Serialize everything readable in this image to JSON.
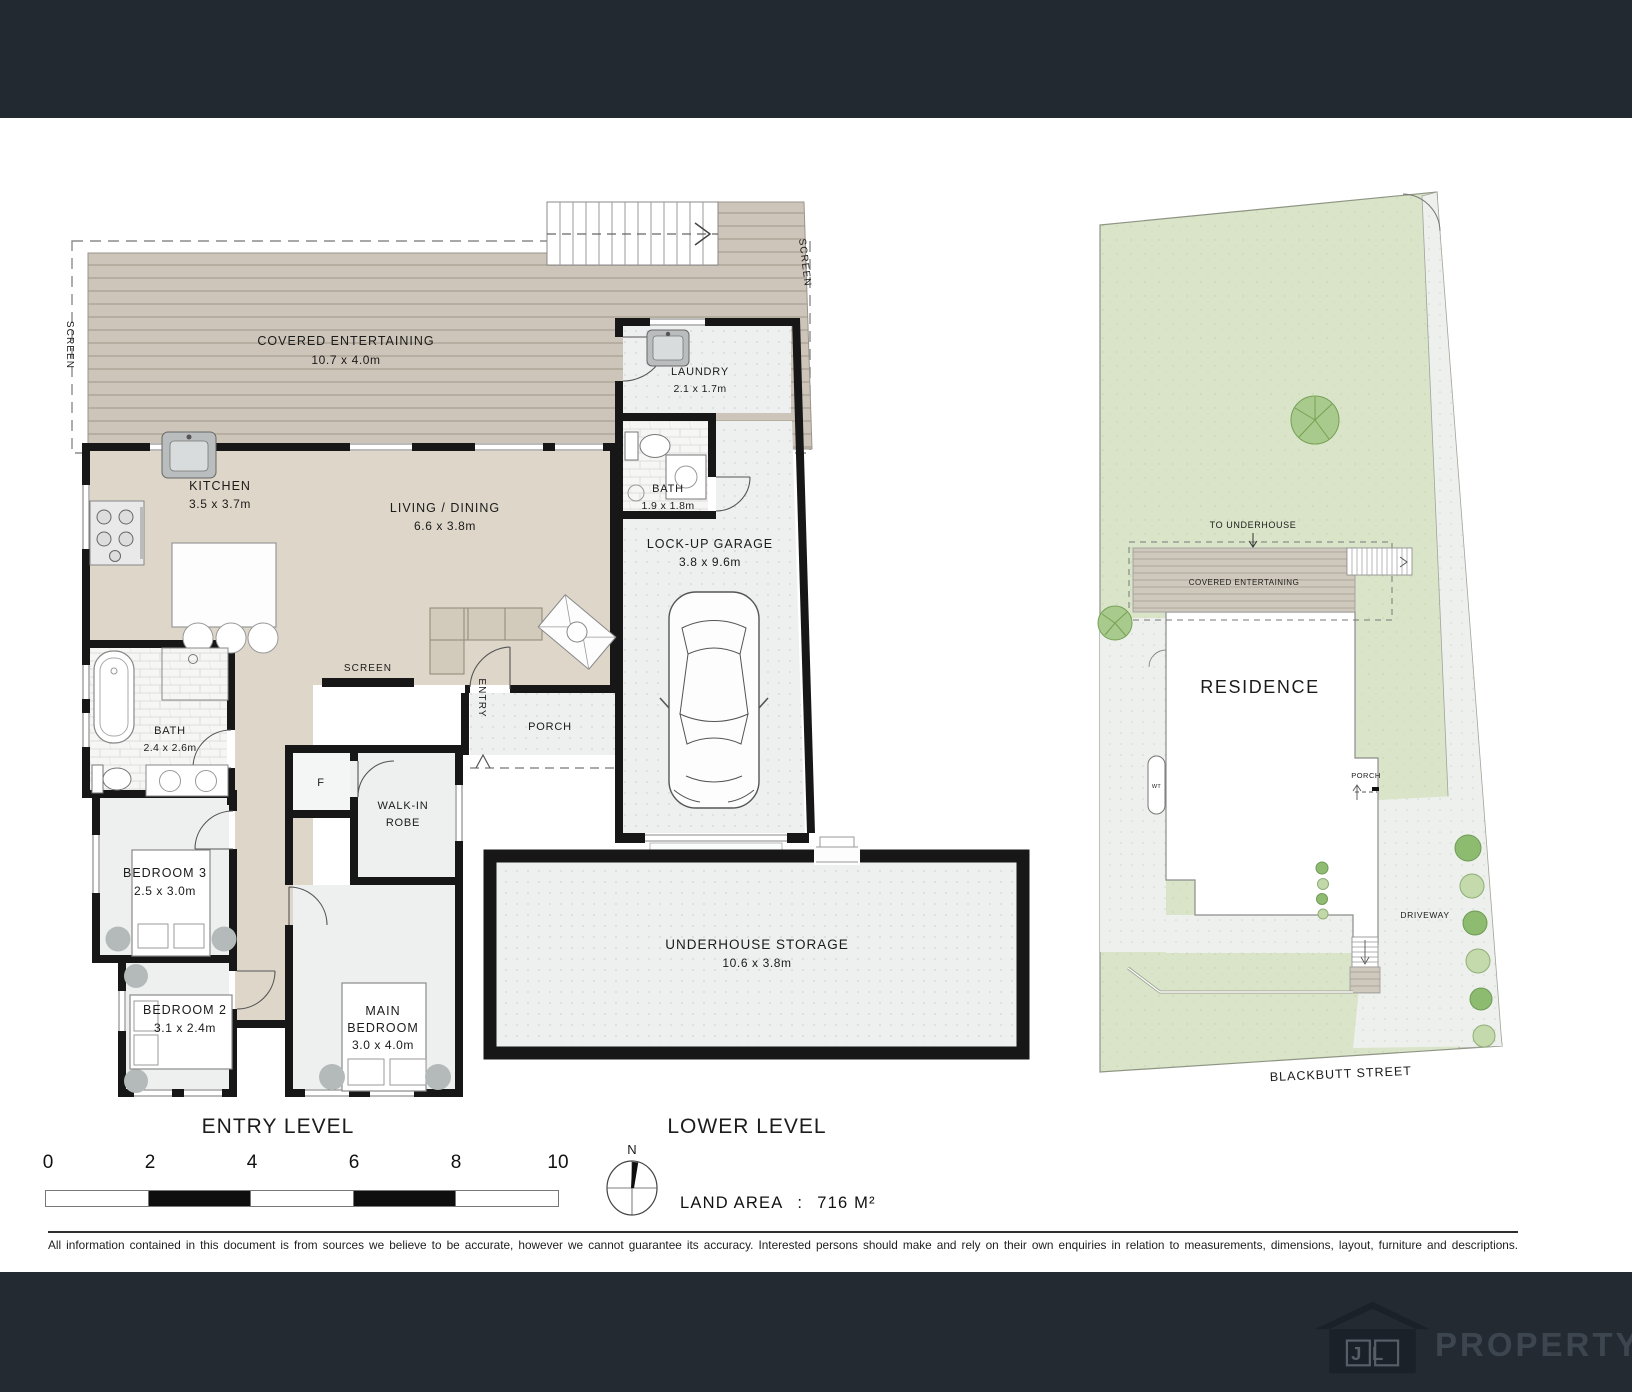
{
  "plan": {
    "entry": {
      "title": "ENTRY LEVEL",
      "covered_entertaining": {
        "name": "COVERED ENTERTAINING",
        "dims": "10.7 x 4.0m"
      },
      "kitchen": {
        "name": "KITCHEN",
        "dims": "3.5 x 3.7m"
      },
      "living_dining": {
        "name": "LIVING / DINING",
        "dims": "6.6 x 3.8m"
      },
      "laundry": {
        "name": "LAUNDRY",
        "dims": "2.1 x 1.7m"
      },
      "bath_top": {
        "name": "BATH",
        "dims": "1.9 x 1.8m"
      },
      "garage": {
        "name": "LOCK-UP GARAGE",
        "dims": "3.8 x 9.6m"
      },
      "bath_left": {
        "name": "BATH",
        "dims": "2.4 x 2.6m"
      },
      "bedroom3": {
        "name": "BEDROOM 3",
        "dims": "2.5 x 3.0m"
      },
      "bedroom2": {
        "name": "BEDROOM 2",
        "dims": "3.1 x 2.4m"
      },
      "main_bedroom": {
        "line1": "MAIN",
        "line2": "BEDROOM",
        "dims": "3.0 x 4.0m"
      },
      "walk_in_robe": {
        "line1": "WALK-IN",
        "line2": "ROBE"
      },
      "porch": "PORCH",
      "entry_door": "ENTRY",
      "fridge": "F",
      "screen_left": "SCREEN",
      "screen_right": "SCREEN",
      "screen_mid": "SCREEN"
    },
    "lower": {
      "title": "LOWER LEVEL",
      "storage": {
        "name": "UNDERHOUSE STORAGE",
        "dims": "10.6 x 3.8m"
      }
    },
    "site": {
      "residence": "RESIDENCE",
      "covered_entertaining": "COVERED ENTERTAINING",
      "to_underhouse": "TO UNDERHOUSE",
      "porch": "PORCH",
      "water_tank": "WT",
      "driveway": "DRIVEWAY",
      "street": "BLACKBUTT STREET"
    }
  },
  "scale_bar": {
    "ticks": [
      "0",
      "2",
      "4",
      "6",
      "8",
      "10"
    ]
  },
  "compass": {
    "north": "N"
  },
  "land_area": {
    "label": "LAND AREA",
    "colon": ":",
    "value": "716 M²"
  },
  "disclaimer": "All information contained in this document is from sources we believe to be accurate, however we cannot guarantee its accuracy. Interested persons should make and rely on their own enquiries in relation to measurements, dimensions, layout, furniture and descriptions.",
  "footer": {
    "logo_initials": "JL",
    "brand": "PROPERTY"
  }
}
